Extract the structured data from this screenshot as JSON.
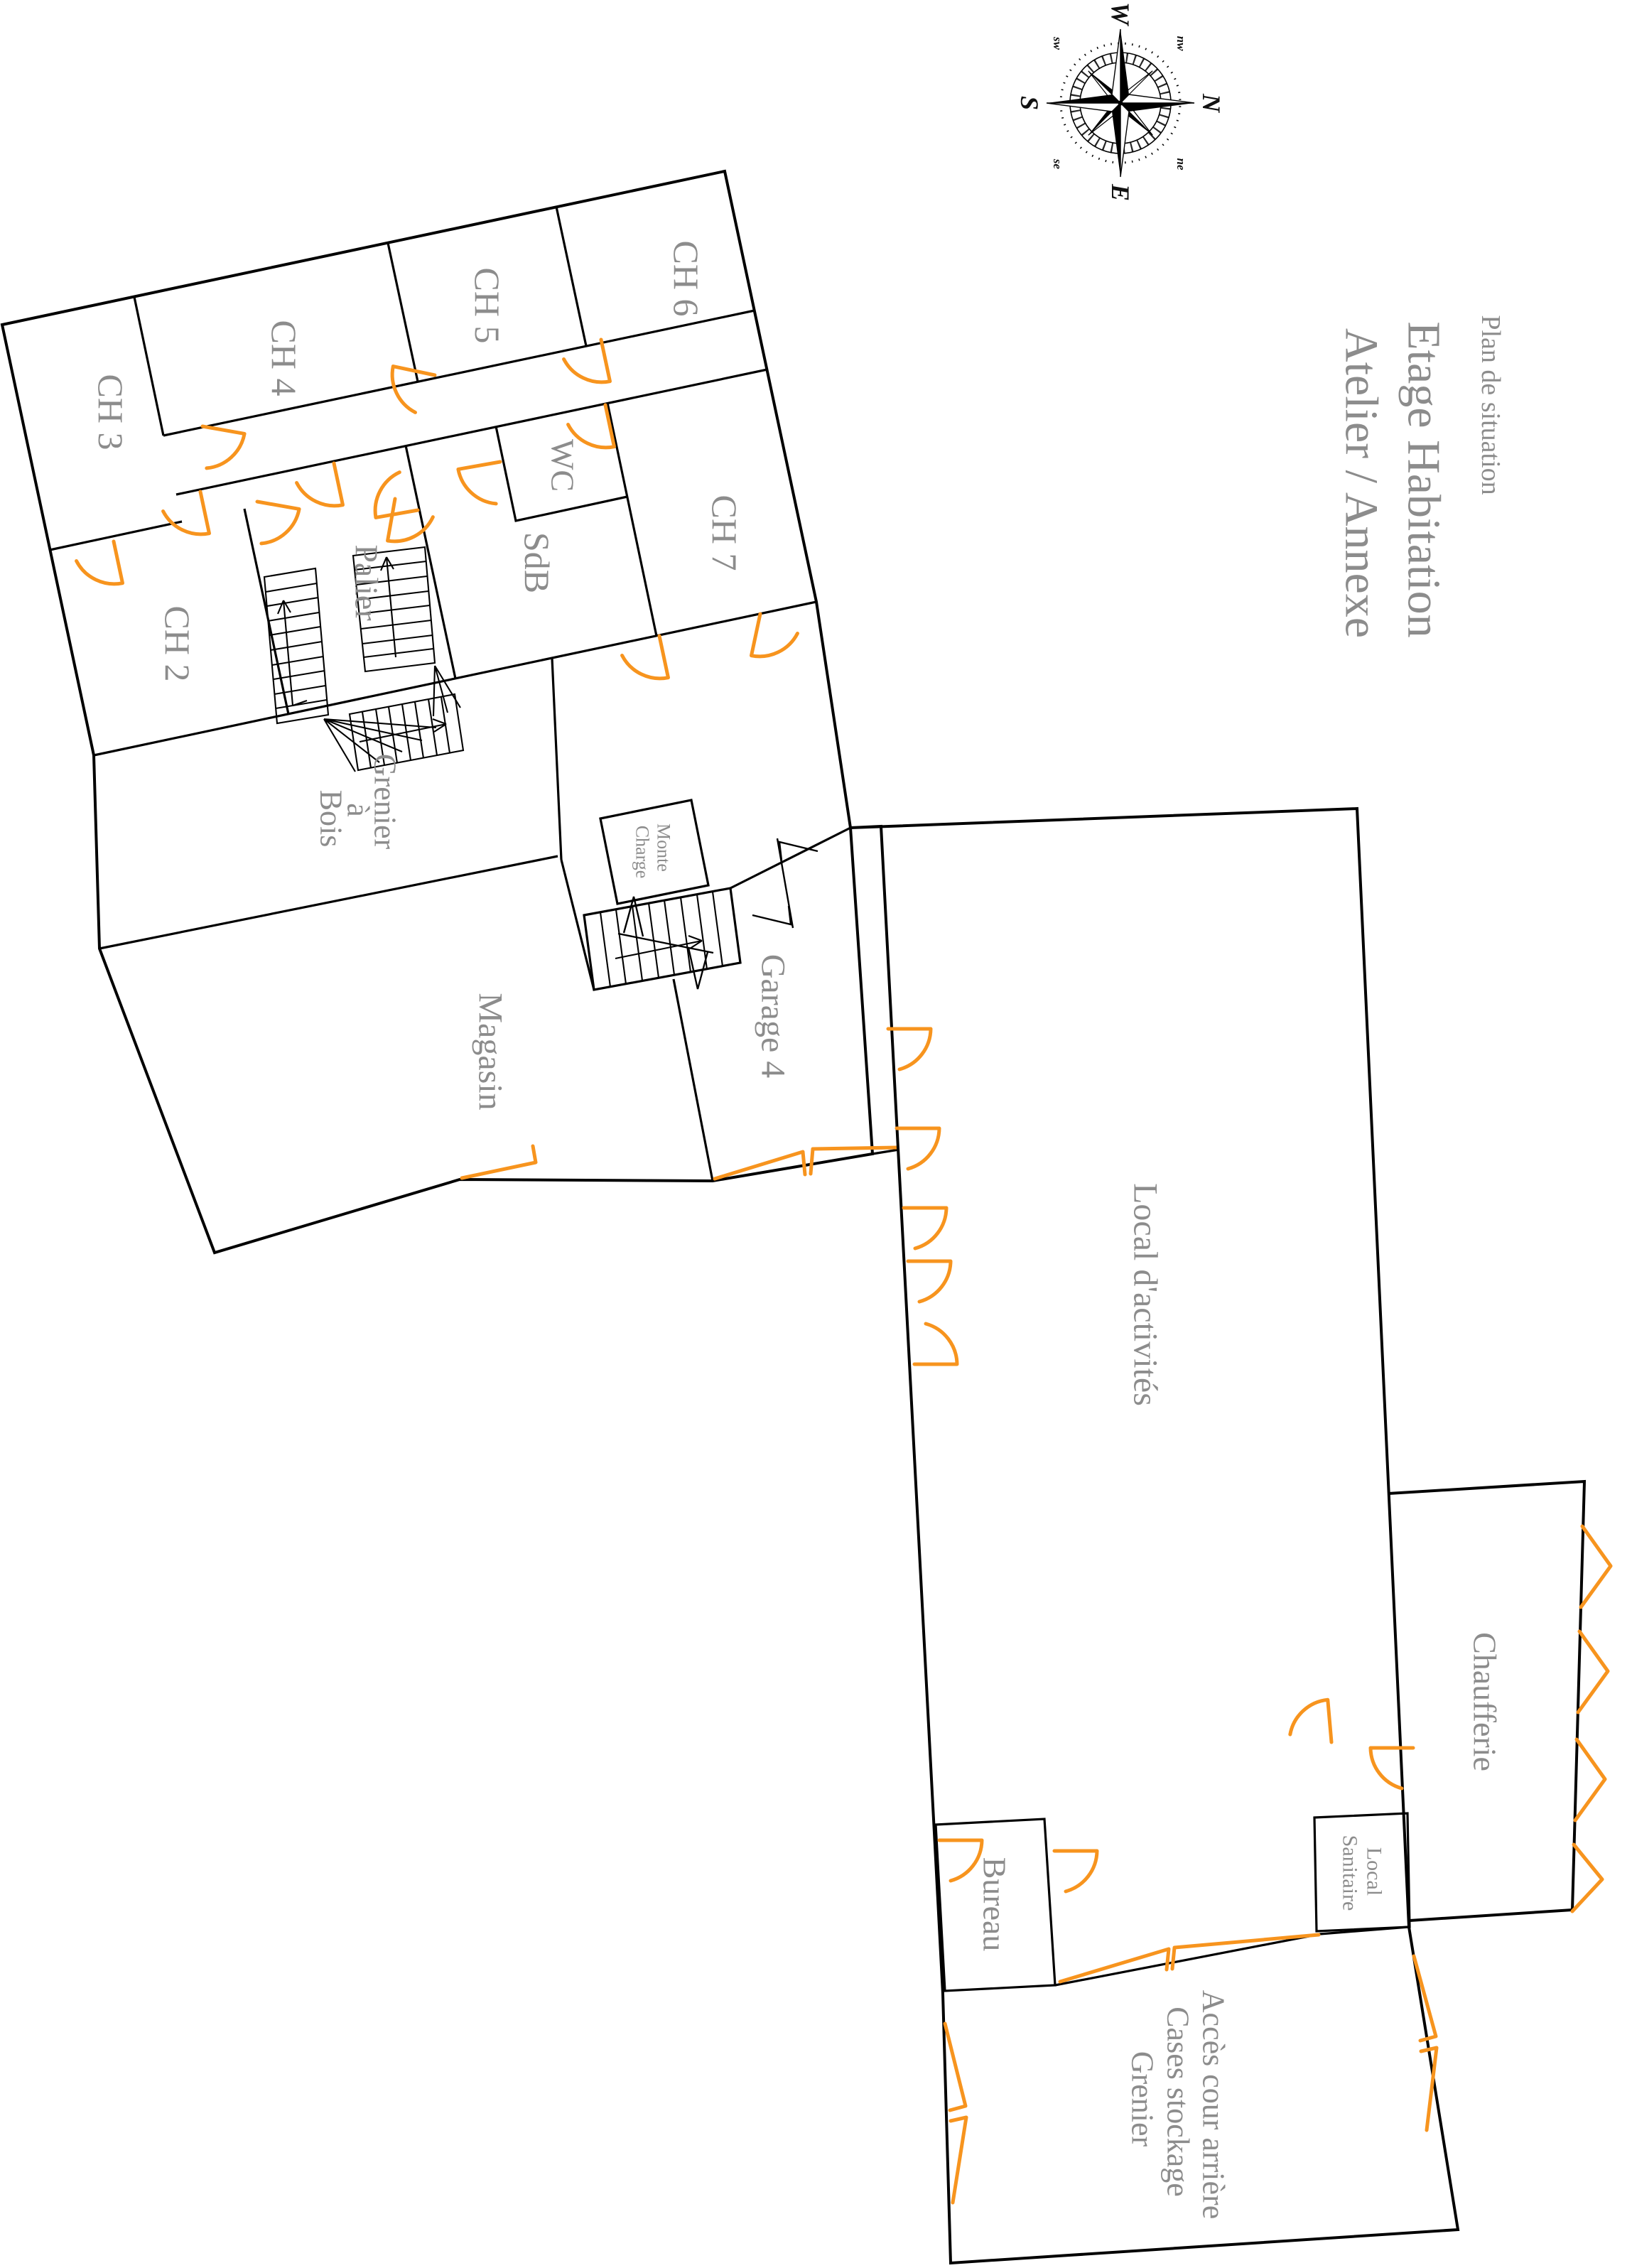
{
  "title": {
    "subtitle": "Plan de situation",
    "line1": "Etage Habitation",
    "line2": "Atelier / Annexe"
  },
  "compass": {
    "n": "N",
    "e": "E",
    "s": "S",
    "w": "W",
    "ne": "ne",
    "nw": "nw",
    "se": "se",
    "sw": "sw"
  },
  "rooms": {
    "ch3": "CH 3",
    "ch4": "CH 4",
    "ch5": "CH 5",
    "ch6": "CH 6",
    "ch7": "CH 7",
    "ch2": "CH 2",
    "wc": "WC",
    "sdb": "SdB",
    "palier": "Palier",
    "grenier_bois": {
      "l1": "Grenier",
      "l2": "à",
      "l3": "Bois"
    },
    "monte_charge": {
      "l1": "Monte",
      "l2": "Charge"
    },
    "magasin": "Magasin",
    "garage4": "Garage 4",
    "local_activites": "Local d'activités",
    "bureau": "Bureau",
    "chaufferie": "Chaufferie",
    "local_sanitaire": {
      "l1": "Local",
      "l2": "Sanitaire"
    },
    "acces": {
      "l1": "Accès cour arrière",
      "l2": "Cases stockage",
      "l3": "Grenier"
    }
  },
  "colors": {
    "wall": "#000000",
    "door_accent": "#F7941E",
    "label_gray": "#8C8C8C"
  }
}
